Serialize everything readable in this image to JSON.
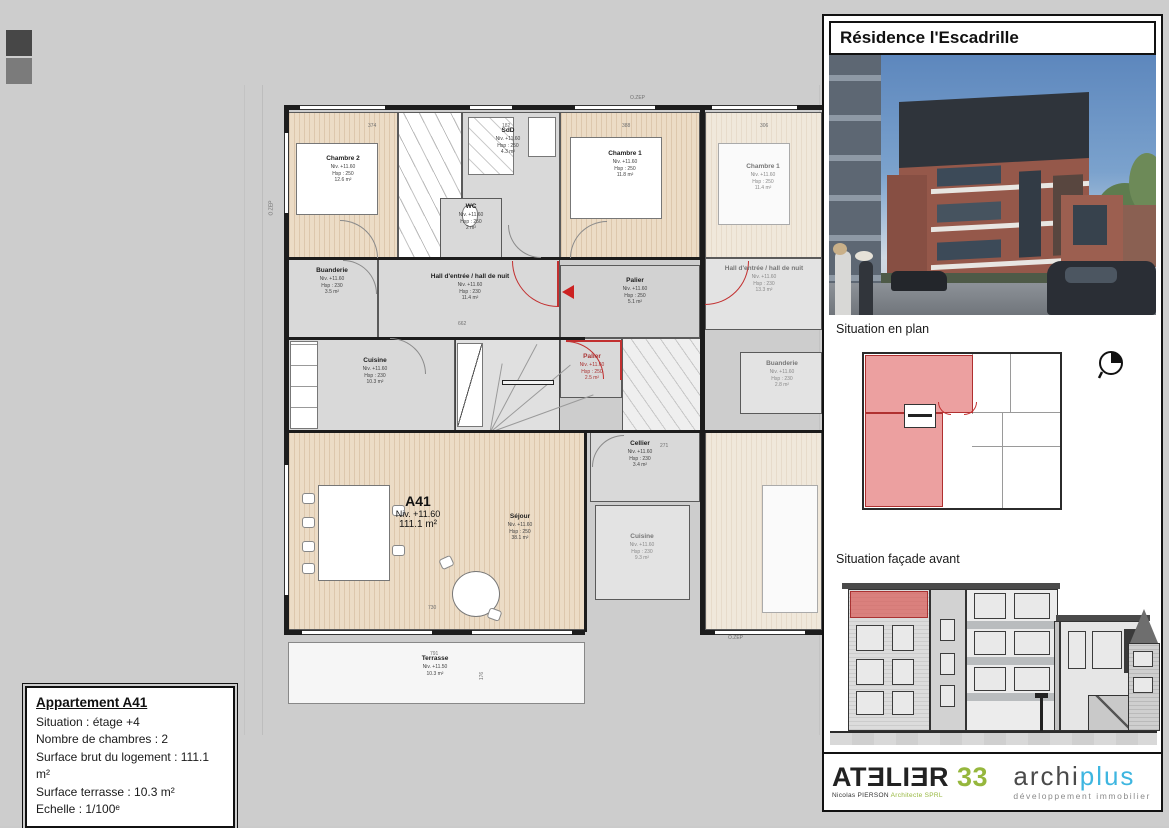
{
  "info_box": {
    "title": "Appartement A41",
    "lines": [
      "Situation : étage +4",
      "Nombre de chambres : 2",
      "Surface brut du logement : 111.1 m²",
      "Surface terrasse : 10.3 m²",
      "Echelle : 1/100ᵉ"
    ]
  },
  "panel": {
    "title": "Résidence l'Escadrille",
    "section_plan_label": "Situation en plan",
    "section_facade_label": "Situation façade avant",
    "logos": {
      "atelier": {
        "wordmark": "ATƎLIƎR",
        "number": "33",
        "subtext": "Nicolas PIERSON",
        "subtext2": "Architecte SPRL",
        "green": "#96b73d"
      },
      "archiplus": {
        "part1": "archi",
        "part2": "plus",
        "subtext": "développement immobilier",
        "blue": "#3eb6e0"
      }
    }
  },
  "plan": {
    "unit_label": {
      "name": "A41",
      "niv": "Niv. +11.60",
      "area": "111.1 m²"
    },
    "rooms": [
      {
        "name": "Chambre 2",
        "niv": "Niv. +11.60",
        "hsp": "Hsp : 250",
        "area": "12.6 m²"
      },
      {
        "name": "SdD",
        "niv": "Niv. +11.60",
        "hsp": "Hsp : 250",
        "area": "4.3 m²"
      },
      {
        "name": "WC",
        "niv": "Niv. +11.60",
        "hsp": "Hsp : 250",
        "area": "2 m²"
      },
      {
        "name": "Chambre 1",
        "niv": "Niv. +11.60",
        "hsp": "Hsp : 250",
        "area": "11.8 m²"
      },
      {
        "name": "Chambre 1",
        "niv": "Niv. +11.60",
        "hsp": "Hsp : 250",
        "area": "11.4 m²"
      },
      {
        "name": "Buanderie",
        "niv": "Niv. +11.60",
        "hsp": "Hsp : 230",
        "area": "3.5 m²"
      },
      {
        "name": "Hall d'entrée / hall de nuit",
        "niv": "Niv. +11.60",
        "hsp": "Hsp : 230",
        "area": "11.4 m²"
      },
      {
        "name": "Palier",
        "niv": "Niv. +11.60",
        "hsp": "Hsp : 250",
        "area": "5.1 m²"
      },
      {
        "name": "Hall d'entrée / hall de nuit",
        "niv": "Niv. +11.60",
        "hsp": "Hsp : 230",
        "area": "13.3 m²"
      },
      {
        "name": "Palier",
        "niv": "Niv. +11.60",
        "hsp": "Hsp : 250",
        "area": "2.5 m²"
      },
      {
        "name": "Buanderie",
        "niv": "Niv. +11.60",
        "hsp": "Hsp : 230",
        "area": "2.8 m²"
      },
      {
        "name": "Cuisine",
        "niv": "Niv. +11.60",
        "hsp": "Hsp : 230",
        "area": "10.3 m²"
      },
      {
        "name": "Cellier",
        "niv": "Niv. +11.60",
        "hsp": "Hsp : 230",
        "area": "3.4 m²"
      },
      {
        "name": "Séjour",
        "niv": "Niv. +11.60",
        "hsp": "Hsp : 250",
        "area": "38.1 m²"
      },
      {
        "name": "Cuisine",
        "niv": "Niv. +11.60",
        "hsp": "Hsp : 230",
        "area": "9.3 m²"
      },
      {
        "name": "Terrasse",
        "niv": "Niv. +11.50",
        "area": "10.3 m²"
      }
    ],
    "dims": {
      "ozep": "O.ZEP",
      "d374": "374",
      "d182": "182",
      "d388": "388",
      "d306": "306",
      "d662": "662",
      "d271": "271",
      "d730": "730",
      "d791": "791",
      "d176": "176"
    },
    "colors": {
      "accent_red": "#c23030",
      "wood": "#ecdcc6",
      "room_gray": "#d9d9d9"
    }
  }
}
